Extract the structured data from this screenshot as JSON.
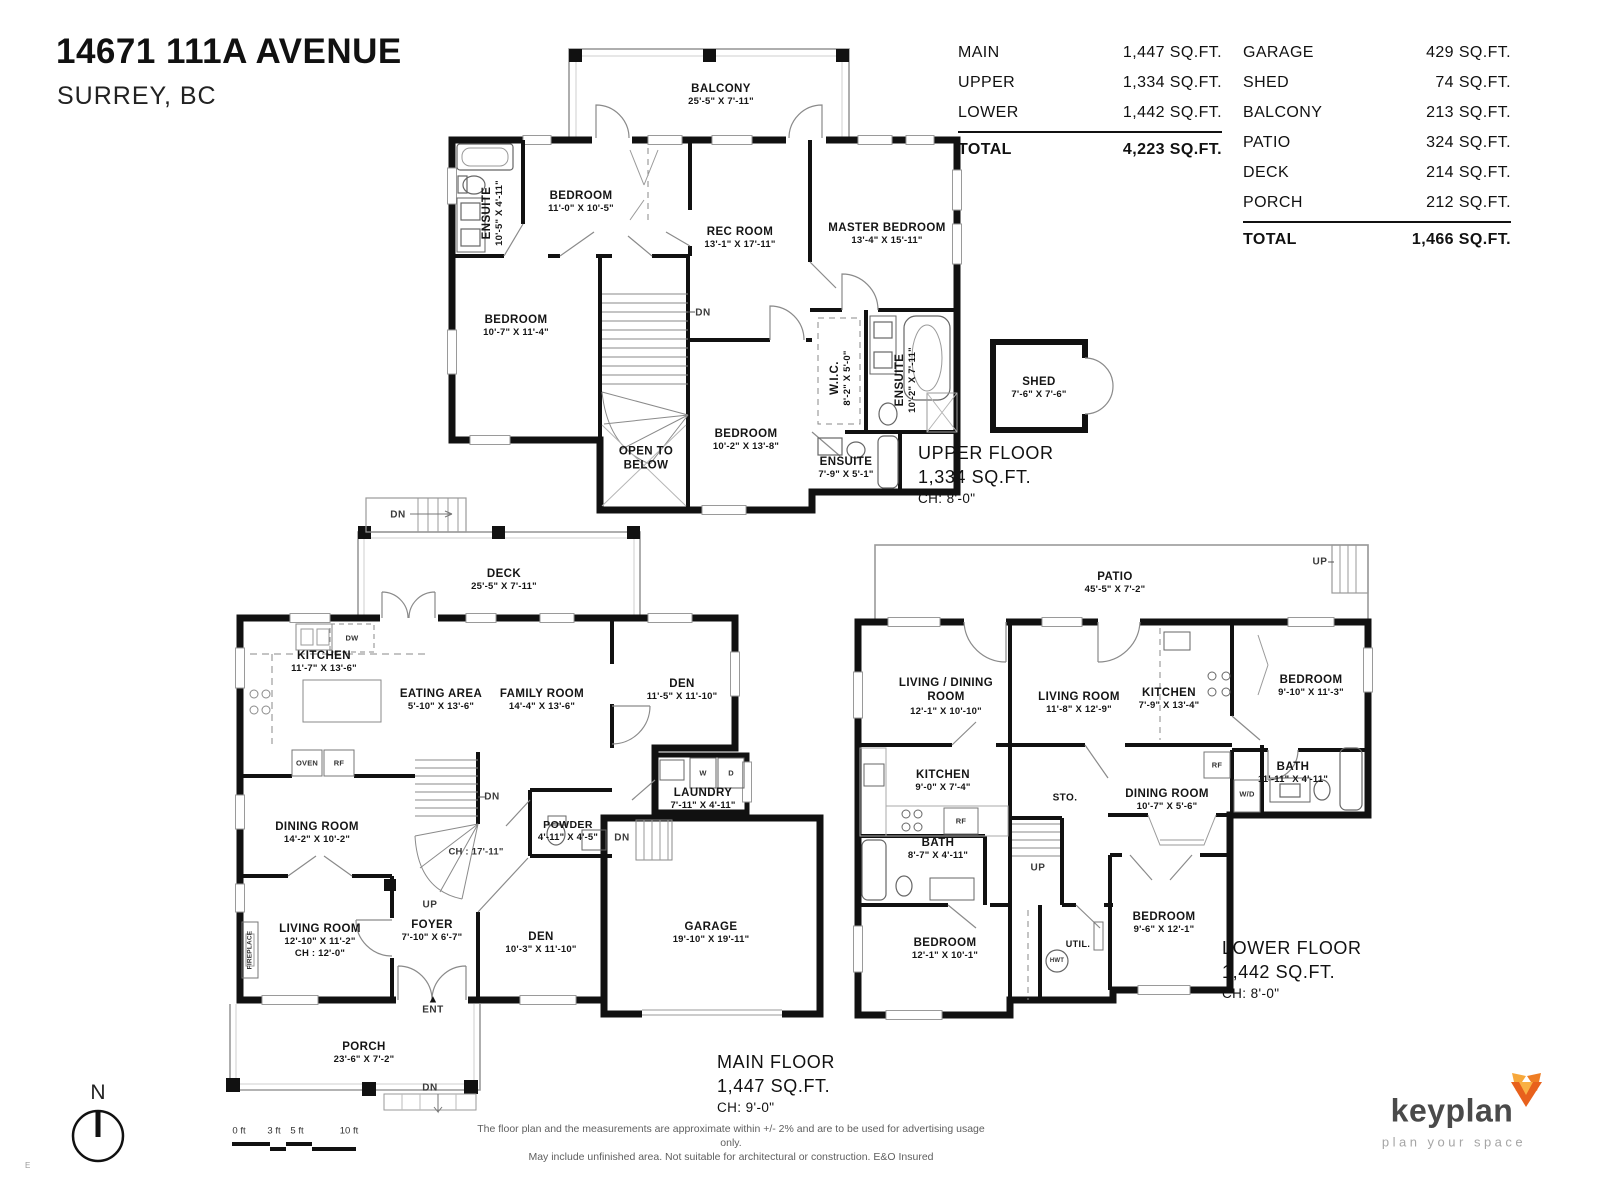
{
  "header": {
    "title": "14671 111A AVENUE",
    "subtitle": "SURREY, BC"
  },
  "tables": {
    "floors": {
      "rows": [
        {
          "label": "MAIN",
          "value": "1,447 SQ.FT."
        },
        {
          "label": "UPPER",
          "value": "1,334 SQ.FT."
        },
        {
          "label": "LOWER",
          "value": "1,442 SQ.FT."
        }
      ],
      "total_label": "TOTAL",
      "total_value": "4,223 SQ.FT."
    },
    "extras": {
      "rows": [
        {
          "label": "GARAGE",
          "value": "429 SQ.FT."
        },
        {
          "label": "SHED",
          "value": "74 SQ.FT."
        },
        {
          "label": "BALCONY",
          "value": "213 SQ.FT."
        },
        {
          "label": "PATIO",
          "value": "324 SQ.FT."
        },
        {
          "label": "DECK",
          "value": "214 SQ.FT."
        },
        {
          "label": "PORCH",
          "value": "212 SQ.FT."
        }
      ],
      "total_label": "TOTAL",
      "total_value": "1,466 SQ.FT."
    }
  },
  "floors": {
    "upper": {
      "summary": {
        "name": "UPPER FLOOR",
        "area": "1,334 SQ.FT.",
        "ceiling": "CH: 8'-0\""
      },
      "rooms": [
        {
          "name": "BALCONY",
          "dims": "25'-5\" X 7'-11\""
        },
        {
          "name": "ENSUITE",
          "dims": "10'-5\" X 4'-11\""
        },
        {
          "name": "BEDROOM",
          "dims": "11'-0\" X 10'-5\""
        },
        {
          "name": "REC ROOM",
          "dims": "13'-1\" X 17'-11\""
        },
        {
          "name": "MASTER BEDROOM",
          "dims": "13'-4\" X 15'-11\""
        },
        {
          "name": "BEDROOM",
          "dims": "10'-7\" X 11'-4\""
        },
        {
          "name": "OPEN TO BELOW",
          "dims": ""
        },
        {
          "name": "BEDROOM",
          "dims": "10'-2\" X 13'-8\""
        },
        {
          "name": "W.I.C.",
          "dims": "8'-2\" X 5'-0\""
        },
        {
          "name": "ENSUITE",
          "dims": "10'-2\" X 7'-11\""
        },
        {
          "name": "ENSUITE",
          "dims": "7'-9\" X 5'-1\""
        },
        {
          "name": "SHED",
          "dims": "7'-6\" X 7'-6\""
        }
      ],
      "annotations": {
        "dn": "DN"
      }
    },
    "main": {
      "summary": {
        "name": "MAIN FLOOR",
        "area": "1,447 SQ.FT.",
        "ceiling": "CH: 9'-0\""
      },
      "rooms": [
        {
          "name": "DECK",
          "dims": "25'-5\" X 7'-11\""
        },
        {
          "name": "KITCHEN",
          "dims": "11'-7\" X 13'-6\""
        },
        {
          "name": "EATING AREA",
          "dims": "5'-10\" X 13'-6\""
        },
        {
          "name": "FAMILY ROOM",
          "dims": "14'-4\" X 13'-6\""
        },
        {
          "name": "DEN",
          "dims": "11'-5\" X 11'-10\""
        },
        {
          "name": "DINING ROOM",
          "dims": "14'-2\" X 10'-2\""
        },
        {
          "name": "POWDER",
          "dims": "4'-11\" X 4'-5\""
        },
        {
          "name": "LAUNDRY",
          "dims": "7'-11\" X 4'-11\""
        },
        {
          "name": "LIVING ROOM",
          "dims": "12'-10\" X 11'-2\"",
          "ceiling": "CH : 12'-0\""
        },
        {
          "name": "FOYER",
          "dims": "7'-10\" X 6'-7\""
        },
        {
          "name": "DEN",
          "dims": "10'-3\" X 11'-10\""
        },
        {
          "name": "GARAGE",
          "dims": "19'-10\" X 19'-11\""
        },
        {
          "name": "PORCH",
          "dims": "23'-6\" X 7'-2\""
        }
      ],
      "annotations": {
        "dn": "DN",
        "up": "UP",
        "ent": "ENT",
        "stair_ch": "CH : 17'-11\"",
        "dw": "DW",
        "oven": "OVEN",
        "rf": "RF",
        "w": "W",
        "d": "D",
        "fireplace": "FIREPLACE"
      }
    },
    "lower": {
      "summary": {
        "name": "LOWER FLOOR",
        "area": "1,442 SQ.FT.",
        "ceiling": "CH: 8'-0\""
      },
      "rooms": [
        {
          "name": "PATIO",
          "dims": "45'-5\" X 7'-2\""
        },
        {
          "name": "LIVING / DINING ROOM",
          "dims": "12'-1\" X 10'-10\""
        },
        {
          "name": "LIVING ROOM",
          "dims": "11'-8\" X 12'-9\""
        },
        {
          "name": "KITCHEN",
          "dims": "7'-9\" X 13'-4\""
        },
        {
          "name": "BEDROOM",
          "dims": "9'-10\" X 11'-3\""
        },
        {
          "name": "KITCHEN",
          "dims": "9'-0\" X 7'-4\""
        },
        {
          "name": "DINING ROOM",
          "dims": "10'-7\" X 5'-6\""
        },
        {
          "name": "BATH",
          "dims": "11'-11\" X 4'-11\""
        },
        {
          "name": "BATH",
          "dims": "8'-7\" X 4'-11\""
        },
        {
          "name": "BEDROOM",
          "dims": "12'-1\" X 10'-1\""
        },
        {
          "name": "BEDROOM",
          "dims": "9'-6\" X 12'-1\""
        },
        {
          "name": "STO.",
          "dims": ""
        },
        {
          "name": "UTIL.",
          "dims": ""
        }
      ],
      "annotations": {
        "up": "UP",
        "rf": "RF",
        "wd": "W/D",
        "hwt": "HWT"
      }
    }
  },
  "footer": {
    "compass_label": "N",
    "scale_ticks": [
      "0 ft",
      "3 ft",
      "5 ft",
      "10 ft"
    ],
    "disclaimer_line1": "The floor plan and the measurements are approximate within +/- 2% and are to be used for advertising usage only.",
    "disclaimer_line2": "May include unfinished area. Not suitable for architectural or construction. E&O Insured",
    "edge_mark": "E"
  },
  "logo": {
    "name": "keyplan",
    "tagline": "plan your space",
    "accent_color": "#ee7623",
    "text_color": "#4a4a4a"
  }
}
